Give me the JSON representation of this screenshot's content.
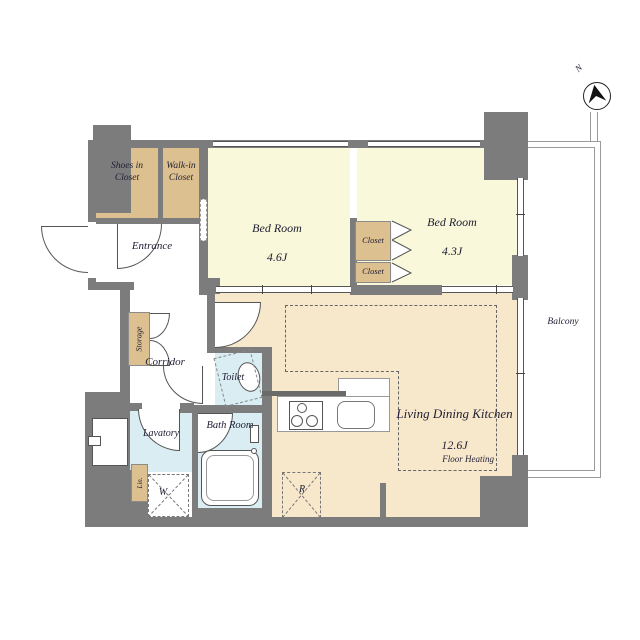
{
  "colors": {
    "wall": "#7c7c7c",
    "closet": "#ddc08f",
    "bedroom": "#faf8da",
    "ldk": "#f8e8cb",
    "wet": "#d9edf2"
  },
  "compass": {
    "north_label": "N"
  },
  "balcony": {
    "label": "Balcony"
  },
  "rooms": {
    "shoes_closet": {
      "label": "Shoes in\nCloset"
    },
    "walk_in_closet": {
      "label": "Walk-in\nCloset"
    },
    "entrance": {
      "label": "Entrance"
    },
    "bedroom_1": {
      "label": "Bed Room",
      "size": "4.6J"
    },
    "bedroom_2": {
      "label": "Bed Room",
      "size": "4.3J"
    },
    "closet_upper": {
      "label": "Closet"
    },
    "closet_lower": {
      "label": "Closet"
    },
    "storage": {
      "label": "Storage"
    },
    "corridor": {
      "label": "Corridor"
    },
    "toilet": {
      "label": "Toilet"
    },
    "bath_room": {
      "label": "Bath Room"
    },
    "lavatory": {
      "label": "Lavatory"
    },
    "linen": {
      "label": "Lin."
    },
    "living_dining_kitchen": {
      "label": "Living Dining Kitchen",
      "size": "12.6J"
    },
    "floor_heating": {
      "label": "Floor Heating"
    }
  },
  "appliances": {
    "washer_label": "W",
    "refrigerator_label": "R"
  }
}
